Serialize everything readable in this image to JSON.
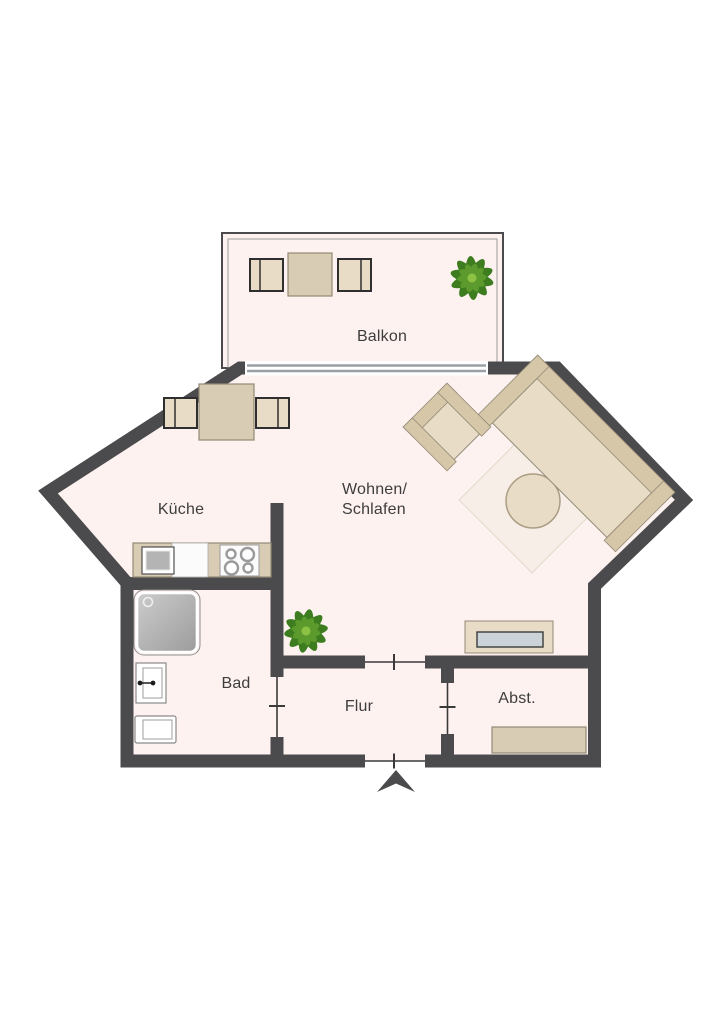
{
  "plan": {
    "rooms": {
      "balcony": {
        "label": "Balkon"
      },
      "kitchen": {
        "label": "Küche"
      },
      "living": {
        "label_line1": "Wohnen/",
        "label_line2": "Schlafen"
      },
      "bath": {
        "label": "Bad"
      },
      "hall": {
        "label": "Flur"
      },
      "storage": {
        "label": "Abst."
      }
    }
  },
  "icons": {
    "plant": "plant-icon",
    "entrance_arrow": "entrance-arrow-icon"
  },
  "colors": {
    "wall": "#4b4b4d",
    "floor": "#fdf2f0",
    "outside": "#ffffff",
    "balcony_inner": "#9b9b9b",
    "furniture": "#d9ccb4",
    "furniture_light": "#e8dcc7",
    "furniture_band": "#d6c7a9",
    "furniture_border": "#938a75",
    "chair_border": "#2f2f2f",
    "counter_white": "#fbfbfb",
    "sink_gray": "#b4b4b4",
    "inner_gray": "#ccd3d8",
    "door": "#3a3a3a",
    "sliding_door": "#9aa0a4",
    "plant_dark": "#3e7d1f",
    "plant_mid": "#5c9a2d",
    "plant_light": "#8cc244",
    "rug": "#f6eee6",
    "text": "#3d3d3d"
  }
}
